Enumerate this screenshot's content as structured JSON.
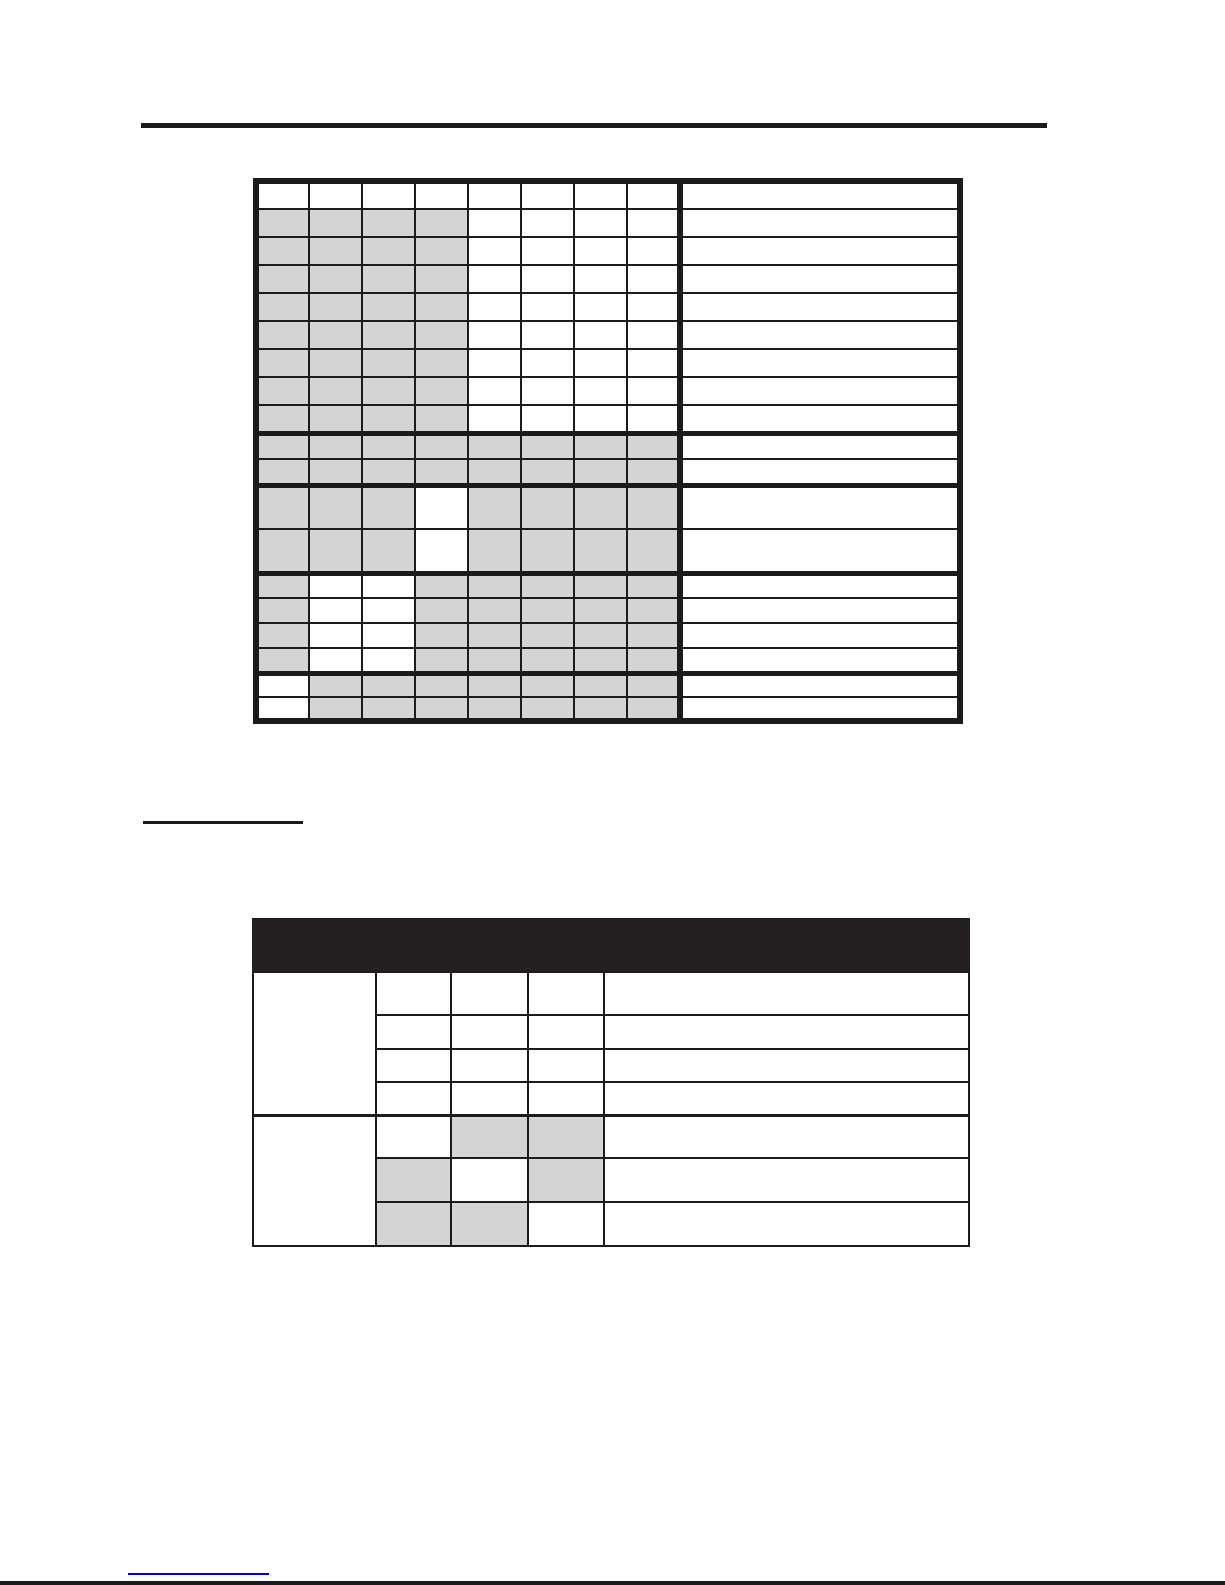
{
  "page": {
    "width": 1225,
    "height": 1585,
    "background": "#ffffff"
  },
  "colors": {
    "ink": "#1c1a1b",
    "gray_fill": "#d4d4d5",
    "header_bar": "#231f20",
    "link_blue": "#0000cc"
  },
  "rules": {
    "top_rule": {
      "x": 141,
      "y": 123,
      "width": 906,
      "height": 5
    },
    "section_heading_underline": {
      "x": 143,
      "y": 821,
      "width": 160,
      "height": 3
    },
    "footer_link_underline": {
      "x": 128,
      "y": 1573,
      "width": 141,
      "height": 2
    },
    "page_bottom_rule": {
      "x": 0,
      "y": 1581,
      "width": 1225,
      "height": 4
    }
  },
  "table1": {
    "x": 253,
    "y": 178,
    "width": 710,
    "narrow_col_width": 53,
    "narrow_col_count": 8,
    "cell_text": "",
    "row_groups": [
      {
        "rows": 1,
        "row_height": 28,
        "shaded": [
          0,
          0,
          0,
          0,
          0,
          0,
          0,
          0
        ],
        "thick_top": false
      },
      {
        "rows": 8,
        "row_height": 28,
        "shaded": [
          1,
          1,
          1,
          1,
          0,
          0,
          0,
          0
        ],
        "thick_top": false
      },
      {
        "rows": 2,
        "row_height": 26,
        "shaded": [
          1,
          1,
          1,
          1,
          1,
          1,
          1,
          1
        ],
        "thick_top": true
      },
      {
        "rows": 2,
        "row_height": 44,
        "shaded": [
          1,
          1,
          1,
          0,
          1,
          1,
          1,
          1
        ],
        "thick_top": true
      },
      {
        "rows": 4,
        "row_height": 25,
        "shaded": [
          1,
          0,
          0,
          1,
          1,
          1,
          1,
          1
        ],
        "thick_top": true
      },
      {
        "rows": 2,
        "row_height": 24,
        "shaded": [
          0,
          1,
          1,
          1,
          1,
          1,
          1,
          1
        ],
        "thick_top": true
      }
    ]
  },
  "table2": {
    "x": 252,
    "y": 918,
    "width": 718,
    "header_height": 53,
    "header_text": "",
    "left_col_width": 123,
    "switch_col_widths": [
      75,
      77,
      76
    ],
    "cell_text": "",
    "groups": [
      {
        "rows": [
          {
            "height": 43,
            "shaded": [
              0,
              0,
              0
            ]
          },
          {
            "height": 34,
            "shaded": [
              0,
              0,
              0
            ]
          },
          {
            "height": 33,
            "shaded": [
              0,
              0,
              0
            ]
          },
          {
            "height": 33,
            "shaded": [
              0,
              0,
              0
            ]
          }
        ]
      },
      {
        "rows": [
          {
            "height": 43,
            "shaded": [
              0,
              1,
              1
            ]
          },
          {
            "height": 44,
            "shaded": [
              1,
              0,
              1
            ]
          },
          {
            "height": 44,
            "shaded": [
              1,
              1,
              0
            ]
          }
        ]
      }
    ]
  }
}
